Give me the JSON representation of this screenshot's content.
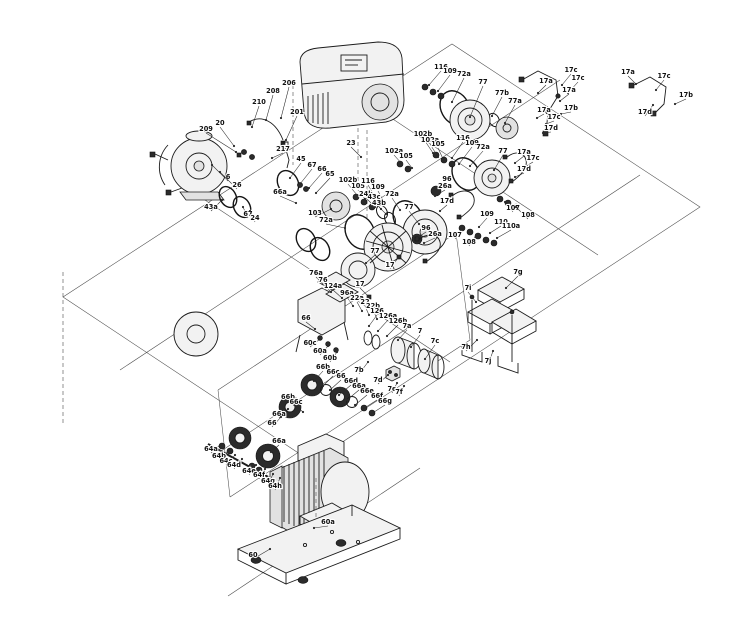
{
  "diagram": {
    "colors": {
      "background": "#ffffff",
      "line": "#1c1c1c",
      "label": "#101010"
    },
    "callouts": [
      {
        "l": "206",
        "x": 289,
        "y": 85,
        "tx": 281,
        "ty": 118
      },
      {
        "l": "208",
        "x": 273,
        "y": 93,
        "tx": 266,
        "ty": 120
      },
      {
        "l": "210",
        "x": 259,
        "y": 104,
        "tx": 252,
        "ty": 127
      },
      {
        "l": "209",
        "x": 206,
        "y": 131,
        "tx": 236,
        "ty": 152
      },
      {
        "l": "20",
        "x": 220,
        "y": 125,
        "tx": 234,
        "ty": 146
      },
      {
        "l": "201",
        "x": 297,
        "y": 114,
        "tx": 286,
        "ty": 140
      },
      {
        "l": "217",
        "x": 283,
        "y": 151,
        "tx": 272,
        "ty": 158
      },
      {
        "l": "6",
        "x": 228,
        "y": 179,
        "tx": 212,
        "ty": 165
      },
      {
        "l": "26",
        "x": 237,
        "y": 187,
        "tx": 220,
        "ty": 172
      },
      {
        "l": "45",
        "x": 301,
        "y": 161,
        "tx": 290,
        "ty": 178
      },
      {
        "l": "67",
        "x": 312,
        "y": 167,
        "tx": 300,
        "ty": 184
      },
      {
        "l": "66",
        "x": 322,
        "y": 171,
        "tx": 309,
        "ty": 188
      },
      {
        "l": "65",
        "x": 330,
        "y": 176,
        "tx": 316,
        "ty": 193
      },
      {
        "l": "66a",
        "x": 280,
        "y": 194,
        "tx": 296,
        "ty": 203
      },
      {
        "l": "103",
        "x": 315,
        "y": 215,
        "tx": 331,
        "ty": 209
      },
      {
        "l": "72a",
        "x": 326,
        "y": 222,
        "tx": 345,
        "ty": 228
      },
      {
        "l": "43a",
        "x": 211,
        "y": 209,
        "tx": 222,
        "ty": 200
      },
      {
        "l": "67",
        "x": 248,
        "y": 216,
        "tx": 243,
        "ty": 207
      },
      {
        "l": "24",
        "x": 255,
        "y": 220,
        "tx": 250,
        "ty": 211
      },
      {
        "l": "23",
        "x": 351,
        "y": 145,
        "tx": 361,
        "ty": 157
      },
      {
        "l": "102b",
        "x": 423,
        "y": 136,
        "tx": 433,
        "ty": 153
      },
      {
        "l": "102a",
        "x": 430,
        "y": 142,
        "tx": 438,
        "ty": 157
      },
      {
        "l": "105",
        "x": 438,
        "y": 146,
        "tx": 444,
        "ty": 161
      },
      {
        "l": "102a",
        "x": 394,
        "y": 153,
        "tx": 402,
        "ty": 164
      },
      {
        "l": "105",
        "x": 406,
        "y": 158,
        "tx": 412,
        "ty": 168
      },
      {
        "l": "116",
        "x": 463,
        "y": 140,
        "tx": 452,
        "ty": 158
      },
      {
        "l": "109",
        "x": 472,
        "y": 145,
        "tx": 459,
        "ty": 164
      },
      {
        "l": "72a",
        "x": 483,
        "y": 149,
        "tx": 470,
        "ty": 166
      },
      {
        "l": "77",
        "x": 503,
        "y": 153,
        "tx": 494,
        "ty": 170
      },
      {
        "l": "96",
        "x": 447,
        "y": 181,
        "tx": 438,
        "ty": 189
      },
      {
        "l": "26a",
        "x": 445,
        "y": 188,
        "tx": 435,
        "ty": 196
      },
      {
        "l": "17a",
        "x": 524,
        "y": 154,
        "tx": 515,
        "ty": 163
      },
      {
        "l": "17c",
        "x": 533,
        "y": 160,
        "tx": 523,
        "ty": 168
      },
      {
        "l": "17d",
        "x": 524,
        "y": 171,
        "tx": 515,
        "ty": 177
      },
      {
        "l": "116",
        "x": 441,
        "y": 69,
        "tx": 429,
        "ty": 85
      },
      {
        "l": "109",
        "x": 450,
        "y": 73,
        "tx": 438,
        "ty": 91
      },
      {
        "l": "72a",
        "x": 464,
        "y": 76,
        "tx": 452,
        "ty": 102
      },
      {
        "l": "77",
        "x": 483,
        "y": 84,
        "tx": 470,
        "ty": 117
      },
      {
        "l": "77b",
        "x": 502,
        "y": 95,
        "tx": 492,
        "ty": 116
      },
      {
        "l": "77a",
        "x": 515,
        "y": 103,
        "tx": 505,
        "ty": 123
      },
      {
        "l": "17a",
        "x": 546,
        "y": 83,
        "tx": 538,
        "ty": 93
      },
      {
        "l": "17c",
        "x": 571,
        "y": 72,
        "tx": 562,
        "ty": 85
      },
      {
        "l": "17c",
        "x": 578,
        "y": 80,
        "tx": 568,
        "ty": 93
      },
      {
        "l": "17a",
        "x": 569,
        "y": 92,
        "tx": 560,
        "ty": 101
      },
      {
        "l": "17b",
        "x": 571,
        "y": 110,
        "tx": 561,
        "ty": 114
      },
      {
        "l": "17a",
        "x": 544,
        "y": 112,
        "tx": 537,
        "ty": 118
      },
      {
        "l": "17c",
        "x": 554,
        "y": 119,
        "tx": 546,
        "ty": 124
      },
      {
        "l": "17d",
        "x": 551,
        "y": 130,
        "tx": 543,
        "ty": 133
      },
      {
        "l": "17a",
        "x": 628,
        "y": 74,
        "tx": 636,
        "ty": 84
      },
      {
        "l": "17c",
        "x": 664,
        "y": 78,
        "tx": 656,
        "ty": 90
      },
      {
        "l": "17b",
        "x": 686,
        "y": 97,
        "tx": 675,
        "ty": 104
      },
      {
        "l": "17d",
        "x": 645,
        "y": 114,
        "tx": 653,
        "ty": 105
      },
      {
        "l": "102b",
        "x": 348,
        "y": 182,
        "tx": 357,
        "ty": 195
      },
      {
        "l": "105",
        "x": 358,
        "y": 188,
        "tx": 365,
        "ty": 199
      },
      {
        "l": "116",
        "x": 368,
        "y": 183,
        "tx": 374,
        "ty": 195
      },
      {
        "l": "109",
        "x": 378,
        "y": 189,
        "tx": 383,
        "ty": 200
      },
      {
        "l": "24b",
        "x": 366,
        "y": 196,
        "tx": 375,
        "ty": 207
      },
      {
        "l": "43c",
        "x": 374,
        "y": 199,
        "tx": 381,
        "ty": 209
      },
      {
        "l": "43b",
        "x": 379,
        "y": 205,
        "tx": 386,
        "ty": 214
      },
      {
        "l": "72a",
        "x": 392,
        "y": 196,
        "tx": 400,
        "ty": 210
      },
      {
        "l": "77",
        "x": 409,
        "y": 209,
        "tx": 419,
        "ty": 224
      },
      {
        "l": "96",
        "x": 426,
        "y": 230,
        "tx": 417,
        "ty": 238
      },
      {
        "l": "26a",
        "x": 435,
        "y": 236,
        "tx": 424,
        "ty": 243
      },
      {
        "l": "17",
        "x": 390,
        "y": 267,
        "tx": 398,
        "ty": 258
      },
      {
        "l": "77",
        "x": 375,
        "y": 253,
        "tx": 366,
        "ty": 263
      },
      {
        "l": "107",
        "x": 455,
        "y": 237,
        "tx": 464,
        "ty": 229
      },
      {
        "l": "108",
        "x": 469,
        "y": 244,
        "tx": 476,
        "ty": 235
      },
      {
        "l": "109",
        "x": 487,
        "y": 216,
        "tx": 479,
        "ty": 227
      },
      {
        "l": "110",
        "x": 501,
        "y": 224,
        "tx": 490,
        "ty": 233
      },
      {
        "l": "110a",
        "x": 511,
        "y": 228,
        "tx": 497,
        "ty": 238
      },
      {
        "l": "107",
        "x": 513,
        "y": 210,
        "tx": 505,
        "ty": 202
      },
      {
        "l": "108",
        "x": 528,
        "y": 217,
        "tx": 516,
        "ty": 207
      },
      {
        "l": "17d",
        "x": 447,
        "y": 203,
        "tx": 440,
        "ty": 211
      },
      {
        "l": "76a",
        "x": 316,
        "y": 275,
        "tx": 325,
        "ty": 286
      },
      {
        "l": "76",
        "x": 323,
        "y": 282,
        "tx": 331,
        "ty": 292
      },
      {
        "l": "124a",
        "x": 333,
        "y": 288,
        "tx": 342,
        "ty": 298
      },
      {
        "l": "96a",
        "x": 347,
        "y": 295,
        "tx": 353,
        "ty": 306
      },
      {
        "l": "22a",
        "x": 357,
        "y": 300,
        "tx": 362,
        "ty": 311
      },
      {
        "l": "22",
        "x": 365,
        "y": 304,
        "tx": 369,
        "ty": 315
      },
      {
        "l": "22b",
        "x": 373,
        "y": 308,
        "tx": 377,
        "ty": 319
      },
      {
        "l": "126",
        "x": 377,
        "y": 313,
        "tx": 369,
        "ty": 326
      },
      {
        "l": "126a",
        "x": 388,
        "y": 318,
        "tx": 378,
        "ty": 331
      },
      {
        "l": "126b",
        "x": 398,
        "y": 323,
        "tx": 387,
        "ty": 336
      },
      {
        "l": "17",
        "x": 360,
        "y": 286,
        "tx": 368,
        "ty": 296
      },
      {
        "l": "66",
        "x": 306,
        "y": 320,
        "tx": 315,
        "ty": 329
      },
      {
        "l": "60c",
        "x": 310,
        "y": 345,
        "tx": 320,
        "ty": 339
      },
      {
        "l": "60a",
        "x": 320,
        "y": 353,
        "tx": 328,
        "ty": 346
      },
      {
        "l": "60b",
        "x": 330,
        "y": 360,
        "tx": 337,
        "ty": 352
      },
      {
        "l": "7a",
        "x": 407,
        "y": 328,
        "tx": 398,
        "ty": 340
      },
      {
        "l": "7",
        "x": 420,
        "y": 333,
        "tx": 411,
        "ty": 347
      },
      {
        "l": "7c",
        "x": 435,
        "y": 343,
        "tx": 425,
        "ty": 359
      },
      {
        "l": "7b",
        "x": 359,
        "y": 372,
        "tx": 368,
        "ty": 362
      },
      {
        "l": "7d",
        "x": 378,
        "y": 382,
        "tx": 388,
        "ty": 375
      },
      {
        "l": "7e",
        "x": 392,
        "y": 391,
        "tx": 397,
        "ty": 383
      },
      {
        "l": "7f",
        "x": 399,
        "y": 394,
        "tx": 404,
        "ty": 386
      },
      {
        "l": "7g",
        "x": 518,
        "y": 274,
        "tx": 506,
        "ty": 288
      },
      {
        "l": "7i",
        "x": 468,
        "y": 290,
        "tx": 476,
        "ty": 302
      },
      {
        "l": "7h",
        "x": 466,
        "y": 349,
        "tx": 477,
        "ty": 340
      },
      {
        "l": "7j",
        "x": 488,
        "y": 363,
        "tx": 493,
        "ty": 351
      },
      {
        "l": "66b",
        "x": 323,
        "y": 369,
        "tx": 314,
        "ty": 381
      },
      {
        "l": "66c",
        "x": 333,
        "y": 374,
        "tx": 323,
        "ty": 386
      },
      {
        "l": "66",
        "x": 341,
        "y": 378,
        "tx": 330,
        "ty": 390
      },
      {
        "l": "66d",
        "x": 351,
        "y": 383,
        "tx": 339,
        "ty": 395
      },
      {
        "l": "66a",
        "x": 359,
        "y": 388,
        "tx": 347,
        "ty": 400
      },
      {
        "l": "66e",
        "x": 367,
        "y": 393,
        "tx": 355,
        "ty": 405
      },
      {
        "l": "66f",
        "x": 377,
        "y": 398,
        "tx": 363,
        "ty": 409
      },
      {
        "l": "66g",
        "x": 385,
        "y": 403,
        "tx": 371,
        "ty": 414
      },
      {
        "l": "66b",
        "x": 288,
        "y": 399,
        "tx": 296,
        "ty": 407
      },
      {
        "l": "66c",
        "x": 296,
        "y": 404,
        "tx": 303,
        "ty": 412
      },
      {
        "l": "66a",
        "x": 279,
        "y": 416,
        "tx": 288,
        "ty": 409
      },
      {
        "l": "66",
        "x": 272,
        "y": 425,
        "tx": 281,
        "ty": 417
      },
      {
        "l": "64a",
        "x": 211,
        "y": 451,
        "tx": 221,
        "ty": 444
      },
      {
        "l": "64b",
        "x": 219,
        "y": 458,
        "tx": 229,
        "ty": 450
      },
      {
        "l": "64c",
        "x": 226,
        "y": 463,
        "tx": 235,
        "ty": 455
      },
      {
        "l": "64d",
        "x": 234,
        "y": 467,
        "tx": 242,
        "ty": 459
      },
      {
        "l": "64e",
        "x": 249,
        "y": 473,
        "tx": 256,
        "ty": 465
      },
      {
        "l": "64f",
        "x": 259,
        "y": 477,
        "tx": 265,
        "ty": 469
      },
      {
        "l": "64g",
        "x": 268,
        "y": 483,
        "tx": 273,
        "ty": 474
      },
      {
        "l": "64h",
        "x": 275,
        "y": 488,
        "tx": 280,
        "ty": 478
      },
      {
        "l": "66a",
        "x": 279,
        "y": 443,
        "tx": 271,
        "ty": 452
      },
      {
        "l": "60a",
        "x": 328,
        "y": 524,
        "tx": 314,
        "ty": 528
      },
      {
        "l": "60",
        "x": 253,
        "y": 557,
        "tx": 270,
        "ty": 549
      }
    ]
  }
}
